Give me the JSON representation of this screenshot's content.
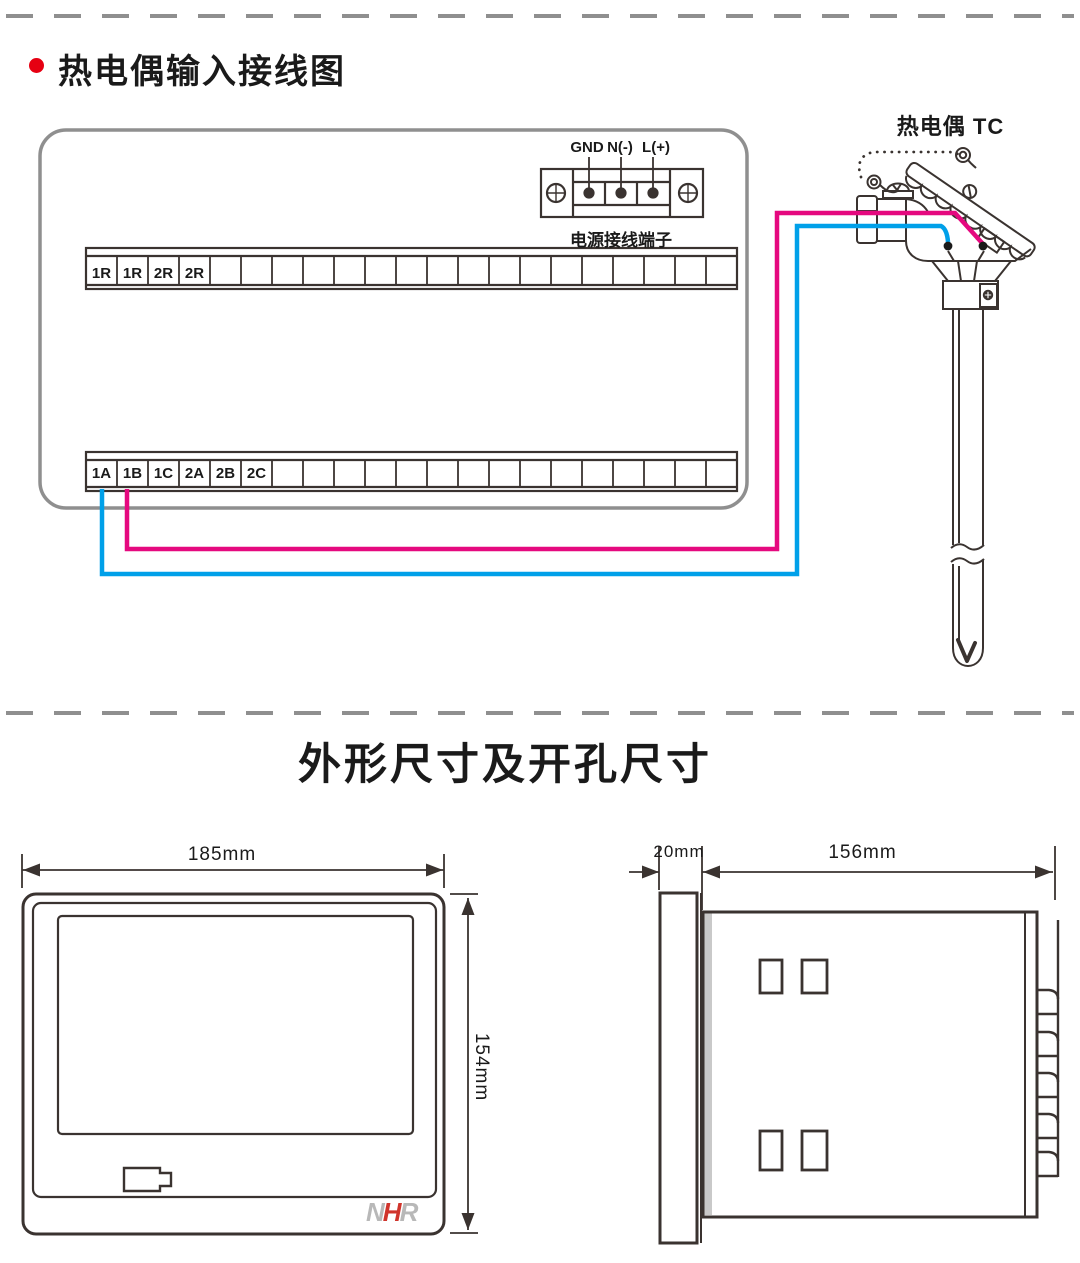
{
  "colors": {
    "line": "#3a3330",
    "panel_gray": "#8f8f8f",
    "wire_pink": "#e5097f",
    "wire_blue": "#00a0e9",
    "bullet_red": "#e60012",
    "logo_gray": "#b8b8b8",
    "logo_red": "#d0342c"
  },
  "section_wiring": {
    "title": "热电偶输入接线图",
    "power_block": {
      "terminal_labels": [
        "GND",
        "N(-)",
        "L(+)"
      ],
      "caption": "电源接线端子"
    },
    "upper_strip_labels": [
      "1R",
      "1R",
      "2R",
      "2R"
    ],
    "lower_strip_labels": [
      "1A",
      "1B",
      "1C",
      "2A",
      "2B",
      "2C"
    ],
    "sensor_label": "热电偶 TC"
  },
  "section_dimensions": {
    "title": "外形尺寸及开孔尺寸",
    "front_view": {
      "width": "185mm",
      "height": "154mm"
    },
    "side_view": {
      "depth": "20mm",
      "length": "156mm"
    },
    "logo": {
      "n": "N",
      "h": "H",
      "r": "R"
    }
  }
}
